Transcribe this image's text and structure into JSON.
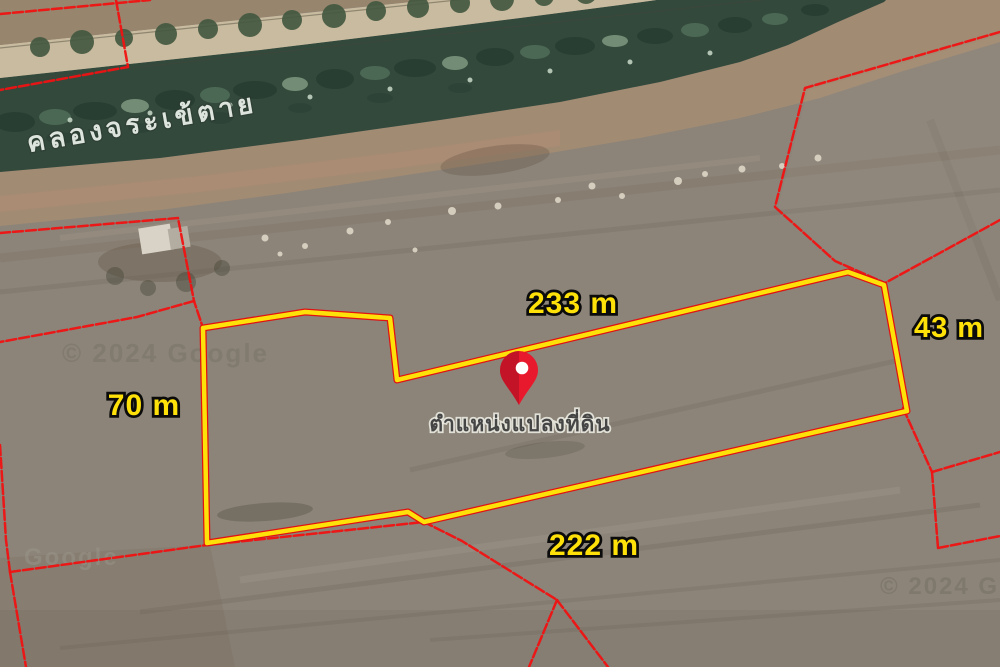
{
  "map": {
    "canal_label": "คลองจระเข้ตาย",
    "pin_label": "ตำแหน่งแปลงที่ดิน",
    "measurements": {
      "top": "233 m",
      "right": "43 m",
      "left": "70 m",
      "bottom": "222 m"
    },
    "watermarks": {
      "center_left": "© 2024 Google",
      "bottom_left": "Google",
      "bottom_right": "© 2024 G"
    },
    "colors": {
      "plot_outline": "#ffe10a",
      "parcel_line": "#f01212",
      "pin_fill": "#e8192c",
      "canal_water": "#33493c",
      "road": "#c9bb9f",
      "dirt_strip": "#a28b73",
      "field": "#8c8479",
      "measurement_text": "#ffe10a"
    }
  }
}
